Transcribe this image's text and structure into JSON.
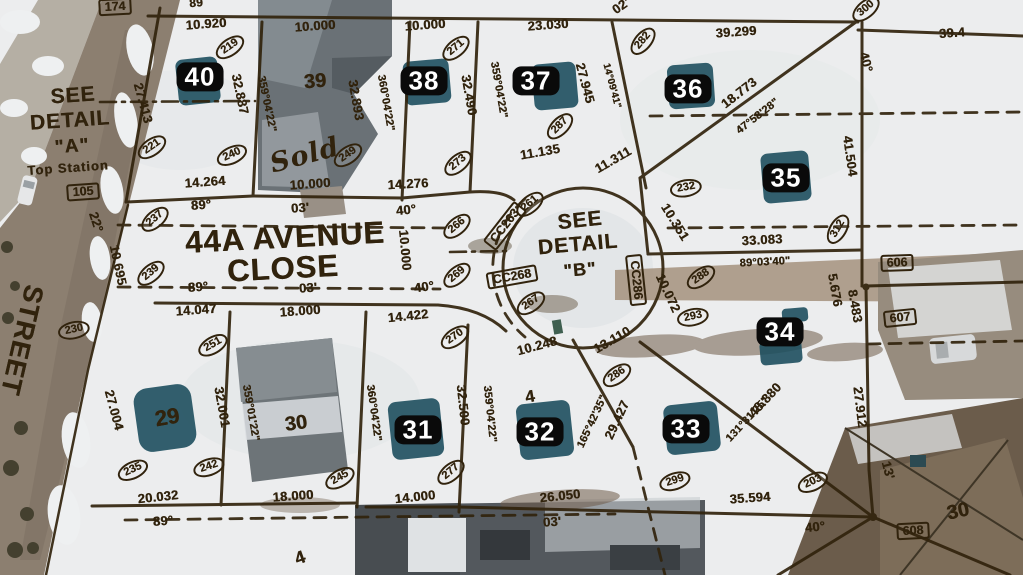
{
  "map": {
    "texts": [
      {
        "name": "detail-a-line1",
        "t": "SEE",
        "x": 73,
        "y": 96,
        "s": 21,
        "r": -4
      },
      {
        "name": "detail-a-line2",
        "t": "DETAIL",
        "x": 70,
        "y": 121,
        "s": 21,
        "r": -4
      },
      {
        "name": "detail-a-line3",
        "t": "\"A\"",
        "x": 72,
        "y": 147,
        "s": 19,
        "r": -4
      },
      {
        "name": "detail-a-note",
        "t": "Top Station",
        "x": 68,
        "y": 168,
        "s": 13,
        "r": -4
      },
      {
        "name": "street-name-line1",
        "t": "44A AVENUE",
        "x": 285,
        "y": 238,
        "s": 31,
        "r": -3
      },
      {
        "name": "street-name-line2",
        "t": "CLOSE",
        "x": 283,
        "y": 269,
        "s": 31,
        "r": -3
      },
      {
        "name": "cross-street-name",
        "t": "STREET",
        "x": 22,
        "y": 340,
        "s": 27,
        "r": 103
      },
      {
        "name": "detail-b-line1",
        "t": "SEE",
        "x": 580,
        "y": 221,
        "s": 21,
        "r": -6
      },
      {
        "name": "detail-b-line2",
        "t": "DETAIL",
        "x": 578,
        "y": 245,
        "s": 21,
        "r": -5
      },
      {
        "name": "detail-b-line3",
        "t": "\"B\"",
        "x": 580,
        "y": 270,
        "s": 18,
        "r": -5
      },
      {
        "name": "handwritten-sold",
        "t": "Sold",
        "x": 305,
        "y": 156,
        "s": 27,
        "r": -15,
        "cls": "script"
      }
    ],
    "lot_badges": [
      {
        "t": "40",
        "x": 200,
        "y": 77
      },
      {
        "t": "38",
        "x": 424,
        "y": 81
      },
      {
        "t": "37",
        "x": 536,
        "y": 81
      },
      {
        "t": "36",
        "x": 688,
        "y": 89
      },
      {
        "t": "35",
        "x": 786,
        "y": 178
      },
      {
        "t": "34",
        "x": 780,
        "y": 332
      },
      {
        "t": "33",
        "x": 686,
        "y": 429
      },
      {
        "t": "32",
        "x": 540,
        "y": 432
      },
      {
        "t": "31",
        "x": 418,
        "y": 430
      }
    ],
    "lot_texts": [
      {
        "t": "39",
        "x": 315,
        "y": 82,
        "r": -5
      },
      {
        "t": "30",
        "x": 296,
        "y": 424,
        "r": -8
      },
      {
        "t": "29",
        "x": 167,
        "y": 417,
        "r": -10,
        "s": 22
      },
      {
        "t": "30",
        "x": 958,
        "y": 512,
        "r": -12
      }
    ],
    "survey_points": [
      {
        "t": "219",
        "x": 230,
        "y": 47,
        "r": -35
      },
      {
        "t": "300",
        "x": 866,
        "y": 9,
        "r": -40
      },
      {
        "t": "282",
        "x": 643,
        "y": 41,
        "r": -50
      },
      {
        "t": "271",
        "x": 456,
        "y": 48,
        "r": -40
      },
      {
        "t": "287",
        "x": 560,
        "y": 126,
        "r": -45
      },
      {
        "t": "221",
        "x": 152,
        "y": 147,
        "r": -35
      },
      {
        "t": "240",
        "x": 232,
        "y": 155,
        "r": -25
      },
      {
        "t": "249",
        "x": 348,
        "y": 155,
        "r": -35
      },
      {
        "t": "273",
        "x": 458,
        "y": 163,
        "r": -40
      },
      {
        "t": "232",
        "x": 686,
        "y": 188,
        "r": -10
      },
      {
        "t": "237",
        "x": 155,
        "y": 219,
        "r": -40
      },
      {
        "t": "239",
        "x": 151,
        "y": 273,
        "r": -40
      },
      {
        "t": "230",
        "x": 74,
        "y": 330,
        "r": -12
      },
      {
        "t": "251",
        "x": 213,
        "y": 345,
        "r": -30
      },
      {
        "t": "266",
        "x": 457,
        "y": 226,
        "r": -40
      },
      {
        "t": "269",
        "x": 457,
        "y": 275,
        "r": -40
      },
      {
        "t": "261",
        "x": 530,
        "y": 204,
        "r": -40
      },
      {
        "t": "267",
        "x": 531,
        "y": 303,
        "r": -35
      },
      {
        "t": "270",
        "x": 455,
        "y": 337,
        "r": -35
      },
      {
        "t": "312",
        "x": 838,
        "y": 229,
        "r": -60
      },
      {
        "t": "288",
        "x": 701,
        "y": 277,
        "r": -35
      },
      {
        "t": "293",
        "x": 693,
        "y": 317,
        "r": -12
      },
      {
        "t": "286",
        "x": 617,
        "y": 375,
        "r": -35
      },
      {
        "t": "277",
        "x": 451,
        "y": 472,
        "r": -40
      },
      {
        "t": "245",
        "x": 340,
        "y": 478,
        "r": -30
      },
      {
        "t": "242",
        "x": 209,
        "y": 467,
        "r": -18
      },
      {
        "t": "235",
        "x": 133,
        "y": 470,
        "r": -25
      },
      {
        "t": "299",
        "x": 675,
        "y": 481,
        "r": -18
      },
      {
        "t": "203",
        "x": 813,
        "y": 482,
        "r": -25
      }
    ],
    "boxed_labels": [
      {
        "t": "174",
        "x": 115,
        "y": 7,
        "r": -3
      },
      {
        "t": "105",
        "x": 83,
        "y": 192,
        "r": -4
      },
      {
        "t": "606",
        "x": 897,
        "y": 263,
        "r": -2
      },
      {
        "t": "607",
        "x": 900,
        "y": 318,
        "r": -6
      },
      {
        "t": "608",
        "x": 913,
        "y": 531,
        "r": -3
      },
      {
        "t": "CC263",
        "x": 505,
        "y": 226,
        "r": -52
      },
      {
        "t": "CC268",
        "x": 512,
        "y": 277,
        "r": -10
      },
      {
        "t": "CC286",
        "x": 636,
        "y": 280,
        "r": 84
      }
    ],
    "measurements": [
      {
        "t": "89",
        "x": 196,
        "y": 3,
        "r": -5,
        "s": 12
      },
      {
        "t": "10.920",
        "x": 206,
        "y": 24,
        "r": -4
      },
      {
        "t": "10.000",
        "x": 315,
        "y": 26,
        "r": -4
      },
      {
        "t": "10.000",
        "x": 425,
        "y": 25,
        "r": -4
      },
      {
        "t": "23.030",
        "x": 548,
        "y": 25,
        "r": -4
      },
      {
        "t": "02'",
        "x": 621,
        "y": 6,
        "r": -35
      },
      {
        "t": "39.299",
        "x": 736,
        "y": 32,
        "r": -4
      },
      {
        "t": "39.4",
        "x": 952,
        "y": 33,
        "r": -4
      },
      {
        "t": "40°",
        "x": 866,
        "y": 62,
        "r": 75
      },
      {
        "t": "27.413",
        "x": 143,
        "y": 103,
        "r": 75
      },
      {
        "t": "32.887",
        "x": 240,
        "y": 94,
        "r": 78
      },
      {
        "t": "359°04'22\"",
        "x": 266,
        "y": 104,
        "r": 78,
        "s": 11
      },
      {
        "t": "32.893",
        "x": 356,
        "y": 100,
        "r": 80
      },
      {
        "t": "360°04'22\"",
        "x": 385,
        "y": 103,
        "r": 80,
        "s": 11
      },
      {
        "t": "32.490",
        "x": 469,
        "y": 95,
        "r": 80
      },
      {
        "t": "359°04'22\"",
        "x": 498,
        "y": 90,
        "r": 80,
        "s": 11
      },
      {
        "t": "27.945",
        "x": 585,
        "y": 83,
        "r": 75
      },
      {
        "t": "14°09'41\"",
        "x": 611,
        "y": 86,
        "r": 75,
        "s": 10
      },
      {
        "t": "18.773",
        "x": 739,
        "y": 93,
        "r": -38
      },
      {
        "t": "47°58'28\"",
        "x": 758,
        "y": 117,
        "r": -38,
        "s": 11
      },
      {
        "t": "41.504",
        "x": 850,
        "y": 156,
        "r": 82
      },
      {
        "t": "11.135",
        "x": 540,
        "y": 152,
        "r": -10
      },
      {
        "t": "11.311",
        "x": 613,
        "y": 160,
        "r": -30
      },
      {
        "t": "14.264",
        "x": 205,
        "y": 182,
        "r": -4
      },
      {
        "t": "10.000",
        "x": 310,
        "y": 184,
        "r": -4
      },
      {
        "t": "14.276",
        "x": 408,
        "y": 184,
        "r": -3
      },
      {
        "t": "89°",
        "x": 201,
        "y": 205,
        "r": -4
      },
      {
        "t": "03'",
        "x": 300,
        "y": 208,
        "r": -4
      },
      {
        "t": "40°",
        "x": 406,
        "y": 210,
        "r": -6
      },
      {
        "t": "10.000",
        "x": 405,
        "y": 250,
        "r": 85
      },
      {
        "t": "40°",
        "x": 424,
        "y": 287,
        "r": -8
      },
      {
        "t": "22°",
        "x": 96,
        "y": 222,
        "r": 72
      },
      {
        "t": "10.695",
        "x": 118,
        "y": 265,
        "r": 78
      },
      {
        "t": "89°",
        "x": 198,
        "y": 287,
        "r": -4
      },
      {
        "t": "03'",
        "x": 308,
        "y": 288,
        "r": -4
      },
      {
        "t": "14.047",
        "x": 196,
        "y": 310,
        "r": -4
      },
      {
        "t": "18.000",
        "x": 300,
        "y": 311,
        "r": -4
      },
      {
        "t": "14.422",
        "x": 408,
        "y": 316,
        "r": -6
      },
      {
        "t": "10.351",
        "x": 675,
        "y": 222,
        "r": 58
      },
      {
        "t": "33.083",
        "x": 762,
        "y": 240,
        "r": -3
      },
      {
        "t": "89°03'40\"",
        "x": 765,
        "y": 263,
        "r": -3,
        "s": 11
      },
      {
        "t": "10.072",
        "x": 668,
        "y": 293,
        "r": 65
      },
      {
        "t": "5.676",
        "x": 835,
        "y": 290,
        "r": 80
      },
      {
        "t": "8.483",
        "x": 855,
        "y": 306,
        "r": 80
      },
      {
        "t": "10.248",
        "x": 537,
        "y": 346,
        "r": -15
      },
      {
        "t": "13.110",
        "x": 612,
        "y": 340,
        "r": -30
      },
      {
        "t": "29.427",
        "x": 617,
        "y": 420,
        "r": -65
      },
      {
        "t": "165°42'35\"",
        "x": 593,
        "y": 422,
        "r": -65,
        "s": 11
      },
      {
        "t": "48.880",
        "x": 765,
        "y": 400,
        "r": -47
      },
      {
        "t": "131°31'25\"",
        "x": 748,
        "y": 420,
        "r": -47,
        "s": 11
      },
      {
        "t": "27.912",
        "x": 860,
        "y": 407,
        "r": 83
      },
      {
        "t": "13'",
        "x": 888,
        "y": 470,
        "r": 75
      },
      {
        "t": "35.594",
        "x": 750,
        "y": 498,
        "r": -4
      },
      {
        "t": "40°",
        "x": 815,
        "y": 527,
        "r": -6
      },
      {
        "t": "26.050",
        "x": 560,
        "y": 496,
        "r": -6
      },
      {
        "t": "03'",
        "x": 552,
        "y": 522,
        "r": -4
      },
      {
        "t": "27.004",
        "x": 114,
        "y": 410,
        "r": 75
      },
      {
        "t": "32.001",
        "x": 222,
        "y": 407,
        "r": 80
      },
      {
        "t": "359°01'22\"",
        "x": 250,
        "y": 413,
        "r": 80,
        "s": 11
      },
      {
        "t": "360°04'22\"",
        "x": 373,
        "y": 413,
        "r": 82,
        "s": 11
      },
      {
        "t": "32.500",
        "x": 463,
        "y": 405,
        "r": 84
      },
      {
        "t": "359°04'22\"",
        "x": 489,
        "y": 414,
        "r": 84,
        "s": 11
      },
      {
        "t": "20.032",
        "x": 158,
        "y": 497,
        "r": -6
      },
      {
        "t": "89°",
        "x": 163,
        "y": 521,
        "r": -4
      },
      {
        "t": "18.000",
        "x": 293,
        "y": 496,
        "r": -4
      },
      {
        "t": "14.000",
        "x": 415,
        "y": 497,
        "r": -6
      },
      {
        "t": "4",
        "x": 530,
        "y": 397,
        "r": -10,
        "s": 17
      },
      {
        "t": "4",
        "x": 300,
        "y": 558,
        "r": -20,
        "s": 18
      }
    ],
    "ink_color": "#31230d",
    "badge_color": "#0a0a0a",
    "teal_patch_color": "#1d4f5e"
  }
}
